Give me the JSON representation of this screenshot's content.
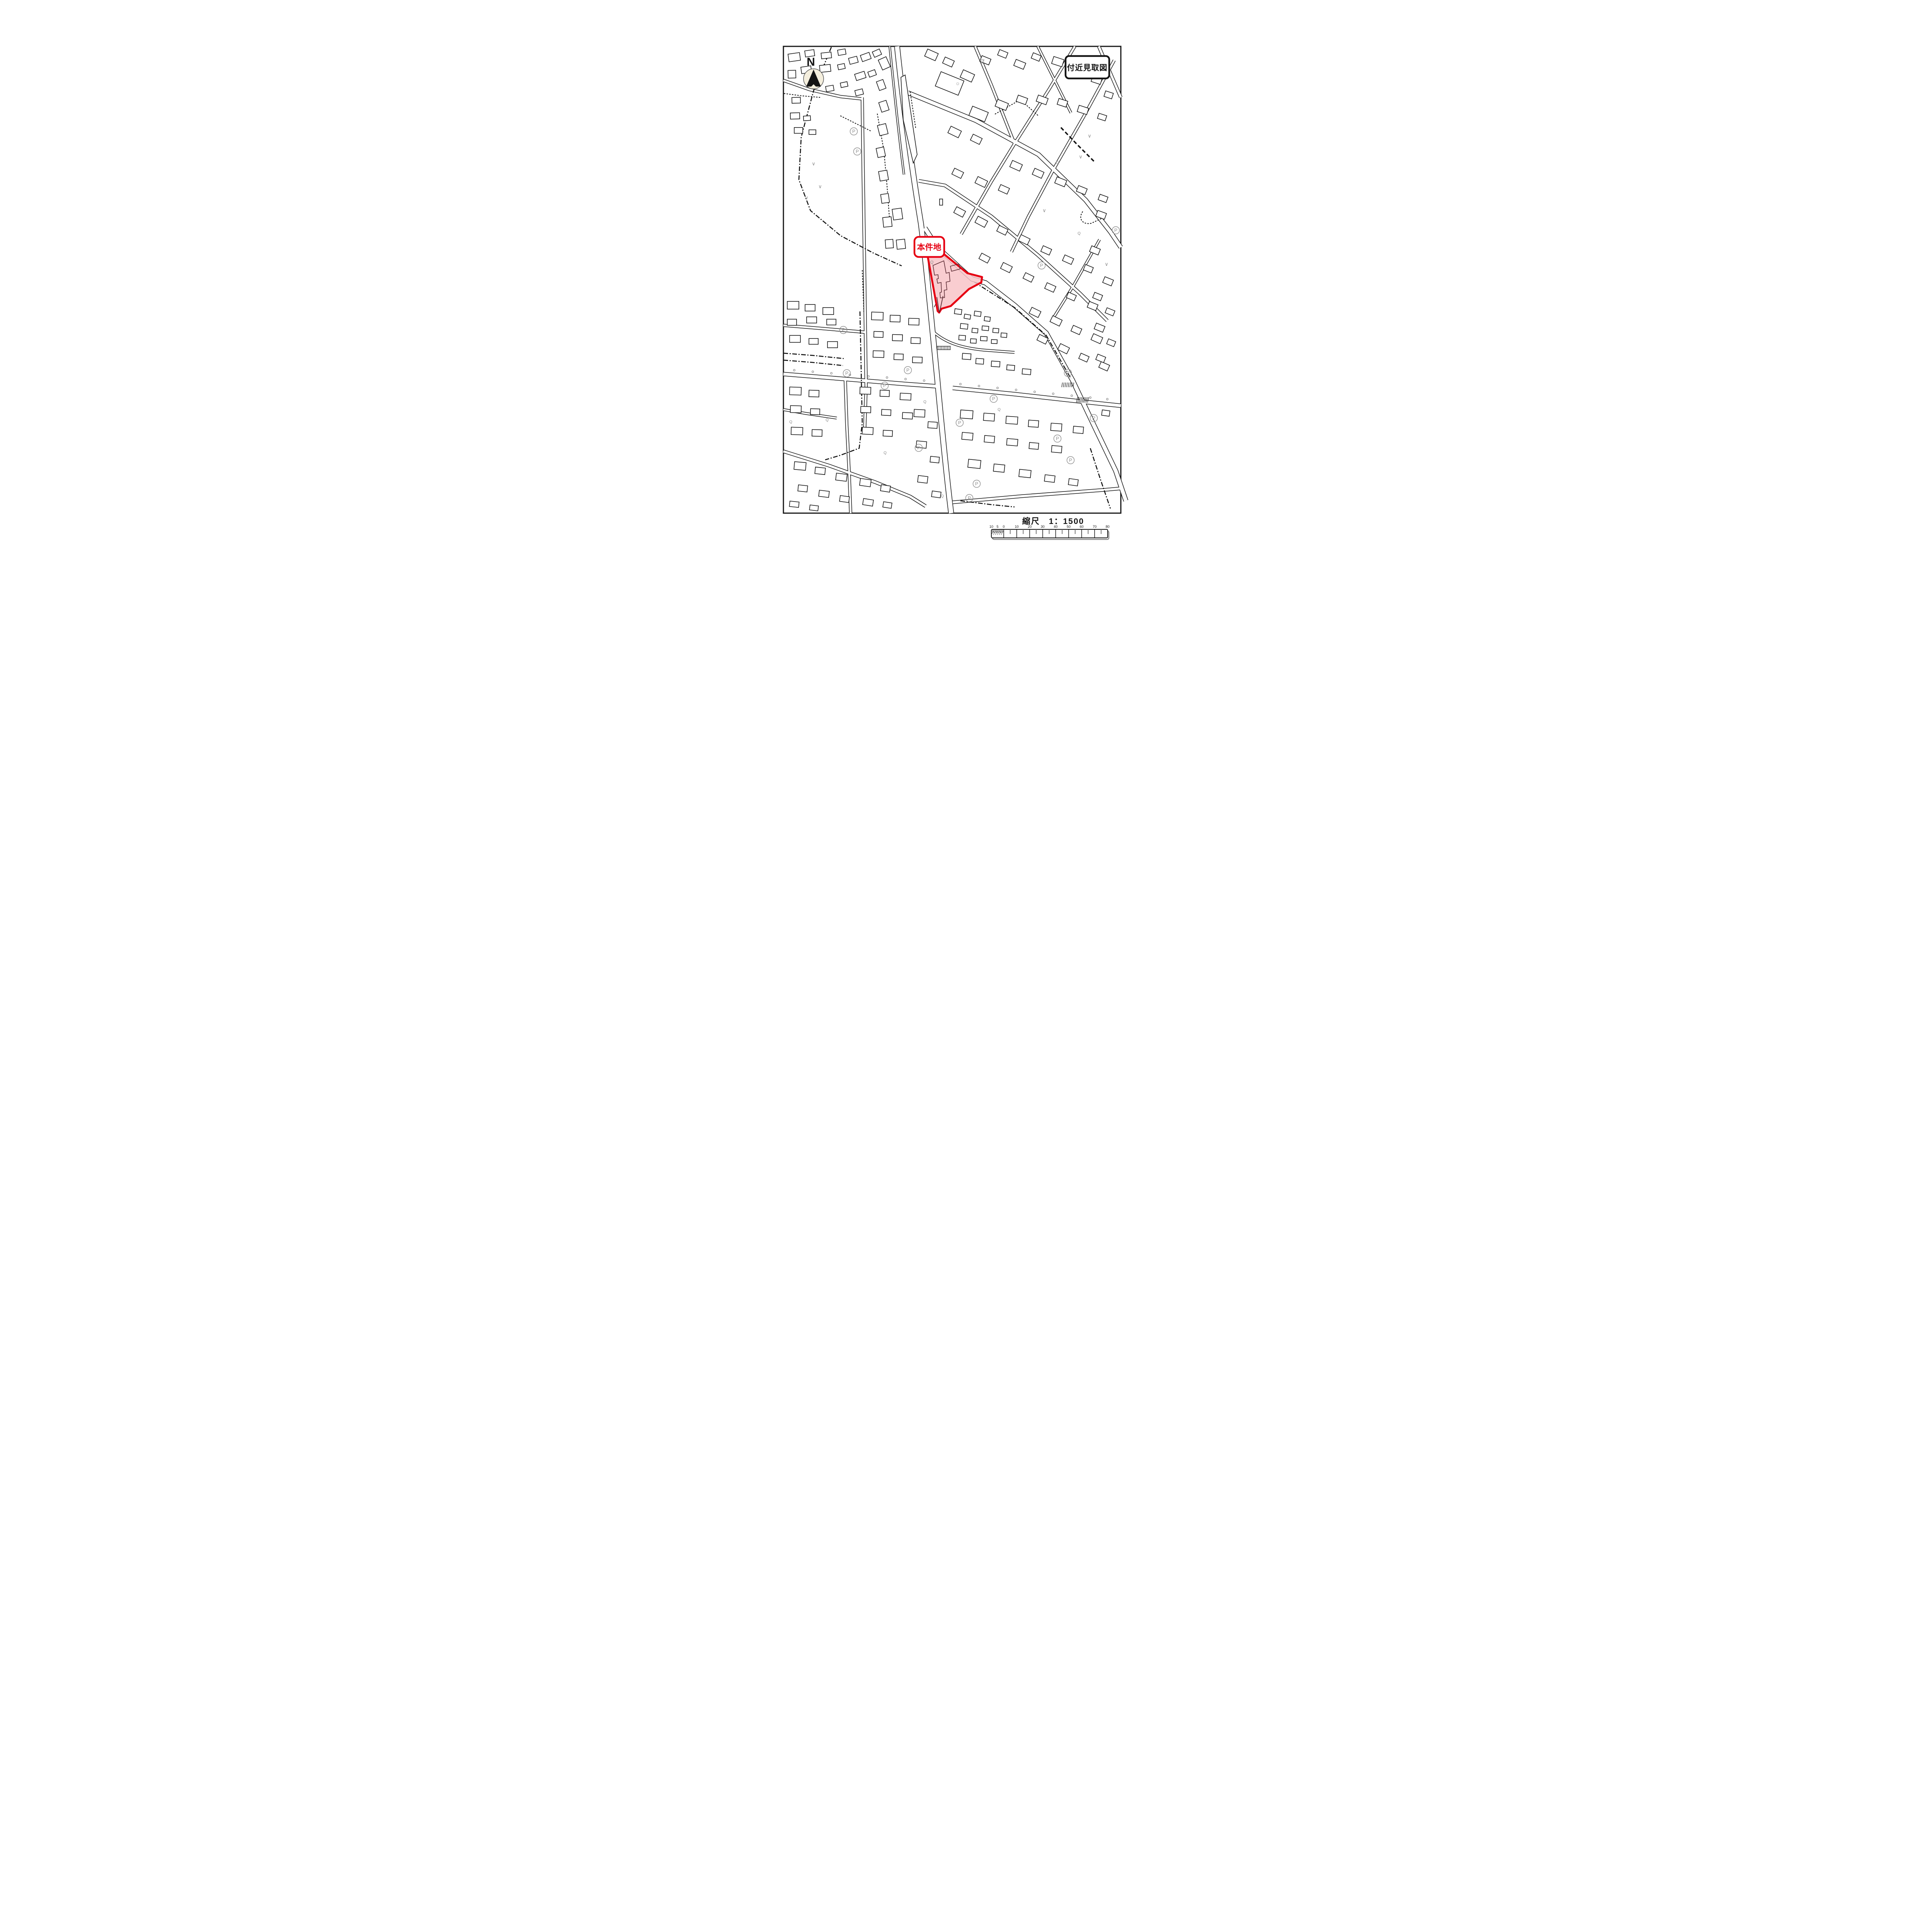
{
  "header": {
    "title": "付近見取図"
  },
  "map": {
    "subject_label": "本件地",
    "north_label": "N",
    "markers": {
      "parking_label": "P",
      "vegetation_mark": "∨",
      "q_mark": "Q",
      "sun_mark": "☼"
    },
    "colors": {
      "subject_fill": "#F8C4C8",
      "subject_stroke": "#E60012",
      "ink": "#141414",
      "marker_gray": "#8C8C8C"
    }
  },
  "scale": {
    "label": "縮尺　1：1500",
    "ratio": "1：1500",
    "tick_labels": [
      "10",
      "5",
      "0",
      "10",
      "20",
      "30",
      "40",
      "50",
      "60",
      "70",
      "80"
    ]
  }
}
